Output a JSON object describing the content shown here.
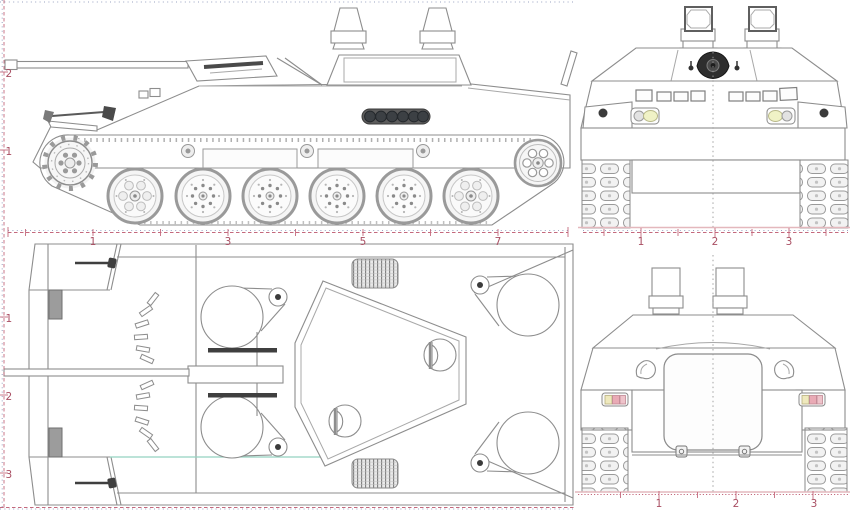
{
  "document": {
    "type": "technical-blueprint",
    "subject": "tracked armored personnel carrier, four-view orthographic drawing",
    "views": [
      "side-elevation",
      "front-elevation",
      "top-plan",
      "rear-elevation"
    ]
  },
  "rulers": {
    "side_horizontal": {
      "labels": [
        "1",
        "3",
        "5",
        "7"
      ]
    },
    "side_vertical": {
      "labels": [
        "2",
        "1"
      ]
    },
    "plan_vertical": {
      "labels": [
        "1",
        "2",
        "3"
      ]
    },
    "front_horizontal": {
      "labels": [
        "1",
        "2",
        "3"
      ]
    },
    "rear_horizontal": {
      "labels": [
        "1",
        "2",
        "3"
      ]
    }
  },
  "colors": {
    "line": "#8d8d8d",
    "dark_fill": "#3b3b3b",
    "ruler_red": "#c4697d",
    "ruler_blue": "#9aa3c2",
    "label_red": "#a94f63",
    "headlight_yellow": "#f0f2c6",
    "taillight_amber": "#efe9bd",
    "taillight_pink": "#e9aab5",
    "deck_teal": "#93d2c0",
    "paper": "#ffffff"
  }
}
